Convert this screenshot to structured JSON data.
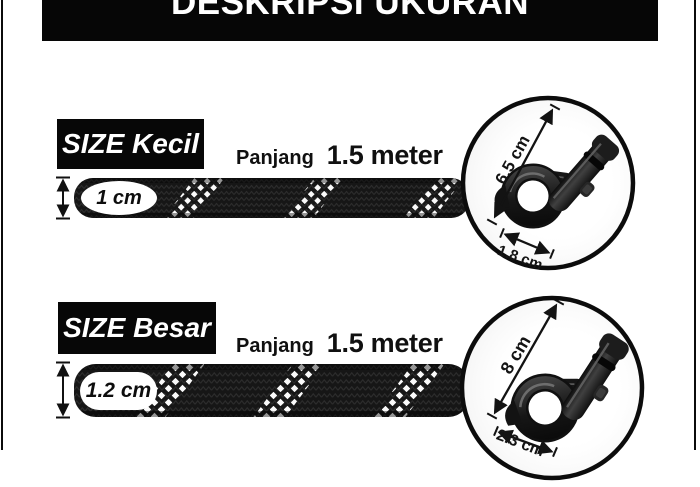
{
  "header": {
    "title": "DESKRIPSI UKURAN"
  },
  "sections": [
    {
      "size_label": "SIZE Kecil",
      "length_label": "Panjang",
      "length_value": "1.5 meter",
      "diameter_label": "1 cm",
      "hook_length_label": "6.5 cm",
      "hook_width_label": "1.8 cm"
    },
    {
      "size_label": "SIZE Besar",
      "length_label": "Panjang",
      "length_value": "1.5 meter",
      "diameter_label": "1.2 cm",
      "hook_length_label": "8 cm",
      "hook_width_label": "2.3 cm"
    }
  ],
  "colors": {
    "banner_bg": "#060606",
    "text": "#101010",
    "rope": "#161616",
    "pattern_white": "#fafafa"
  }
}
